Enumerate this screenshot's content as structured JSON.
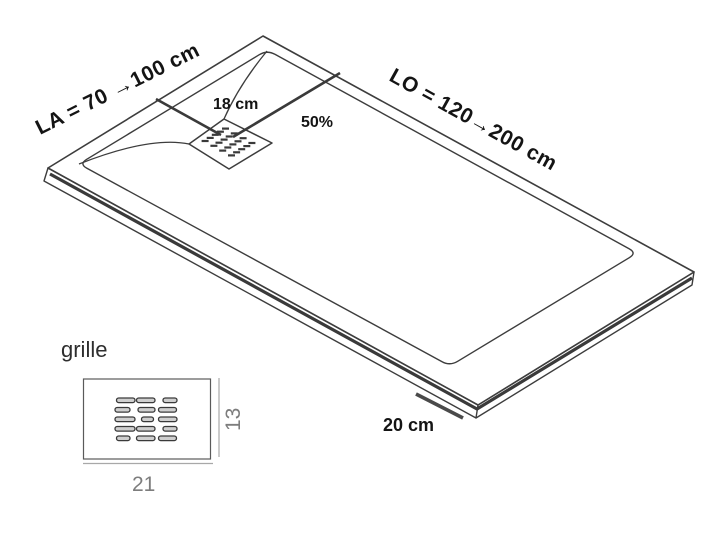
{
  "tray_diagram": {
    "labels": {
      "width_range": "LA = 70 →100 cm",
      "length_range": "LO = 120→200 cm",
      "drain_edge_distance": "18 cm",
      "drain_length_position": "50%",
      "edge_detail": "20 cm"
    },
    "colors": {
      "line": "#3d3d3d",
      "thick_line": "#3a3a3a",
      "text": "#141414"
    },
    "drain_grate": {
      "center": [
        228.5,
        142
      ],
      "rows": 5,
      "cols": 4,
      "row_step": [
        -5.1,
        3.1
      ],
      "col_step": [
        8.8,
        4.8
      ],
      "dash_len": 7,
      "dash_width": 2.2
    }
  },
  "grille_detail": {
    "label": "grille",
    "width_value": "21",
    "height_value": "13",
    "colors": {
      "outline": "#5a5a5a",
      "dimension_line": "#a8a8a8",
      "dimension_text": "#7d7d7d",
      "slot_stroke": "#3a3a3a",
      "slot_fill": "#cfcfcf"
    },
    "slot_height": 4.6,
    "slot_rows": [
      {
        "y": 398.0,
        "slots": [
          [
            116.5,
            18.5
          ],
          [
            136.5,
            18.5
          ],
          [
            163.0,
            14.0
          ]
        ]
      },
      {
        "y": 407.5,
        "slots": [
          [
            115.0,
            15.0
          ],
          [
            138.0,
            17.0
          ],
          [
            158.5,
            18.0
          ]
        ]
      },
      {
        "y": 417.0,
        "slots": [
          [
            115.0,
            20.0
          ],
          [
            141.5,
            12.0
          ],
          [
            158.5,
            18.5
          ]
        ]
      },
      {
        "y": 426.5,
        "slots": [
          [
            115.0,
            20.0
          ],
          [
            136.5,
            18.5
          ],
          [
            163.0,
            14.0
          ]
        ]
      },
      {
        "y": 436.0,
        "slots": [
          [
            116.5,
            13.5
          ],
          [
            136.5,
            18.5
          ],
          [
            158.5,
            18.0
          ]
        ]
      }
    ]
  }
}
